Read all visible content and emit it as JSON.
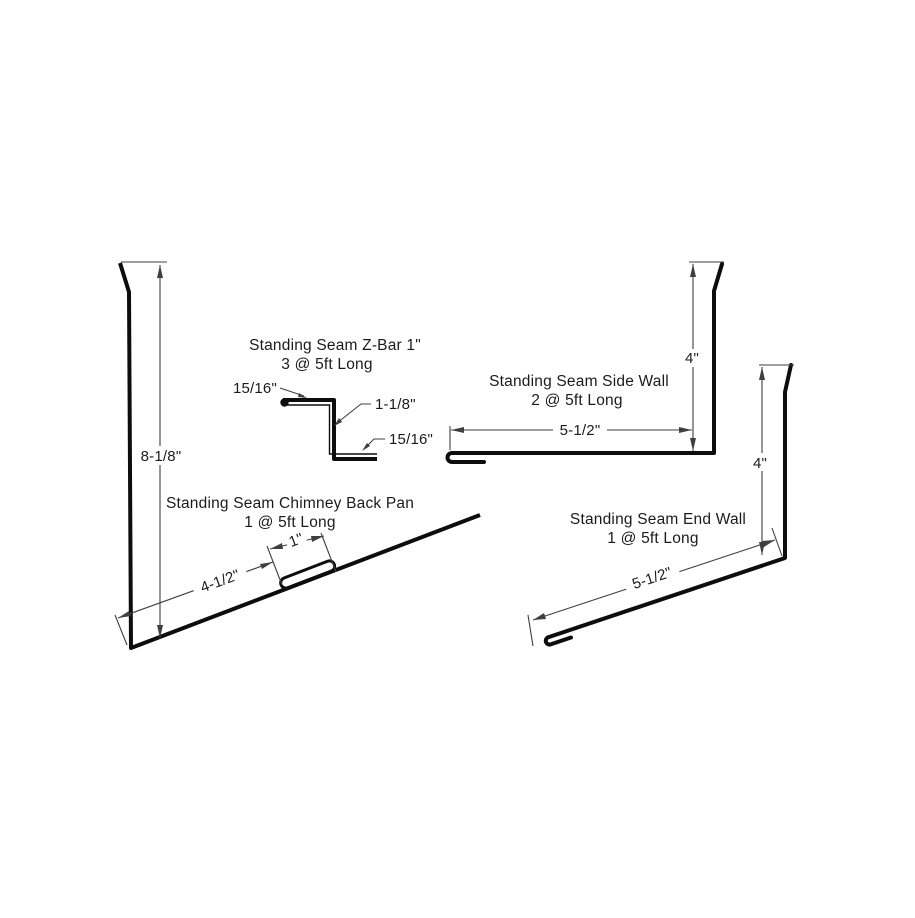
{
  "drawing": {
    "background_color": "#ffffff",
    "profile_line_color": "#0d0d0d",
    "dimension_line_color": "#3f3f3f",
    "profiles": {
      "chimney_back_pan": {
        "title": "Standing Seam Chimney Back Pan",
        "qty": "1 @ 5ft Long",
        "height_dim": "8-1/8\"",
        "slope_run_dim": "4-1/2\"",
        "fold_dim": "1\""
      },
      "z_bar": {
        "title": "Standing Seam Z-Bar 1\"",
        "qty": "3 @ 5ft Long",
        "top_leg_dim": "15/16\"",
        "web_dim": "1-1/8\"",
        "bottom_leg_dim": "15/16\""
      },
      "side_wall": {
        "title": "Standing Seam Side Wall",
        "qty": "2 @ 5ft Long",
        "height_dim": "4\"",
        "width_dim": "5-1/2\""
      },
      "end_wall": {
        "title": "Standing Seam End Wall",
        "qty": "1 @ 5ft Long",
        "height_dim": "4\"",
        "width_dim": "5-1/2\""
      }
    }
  }
}
